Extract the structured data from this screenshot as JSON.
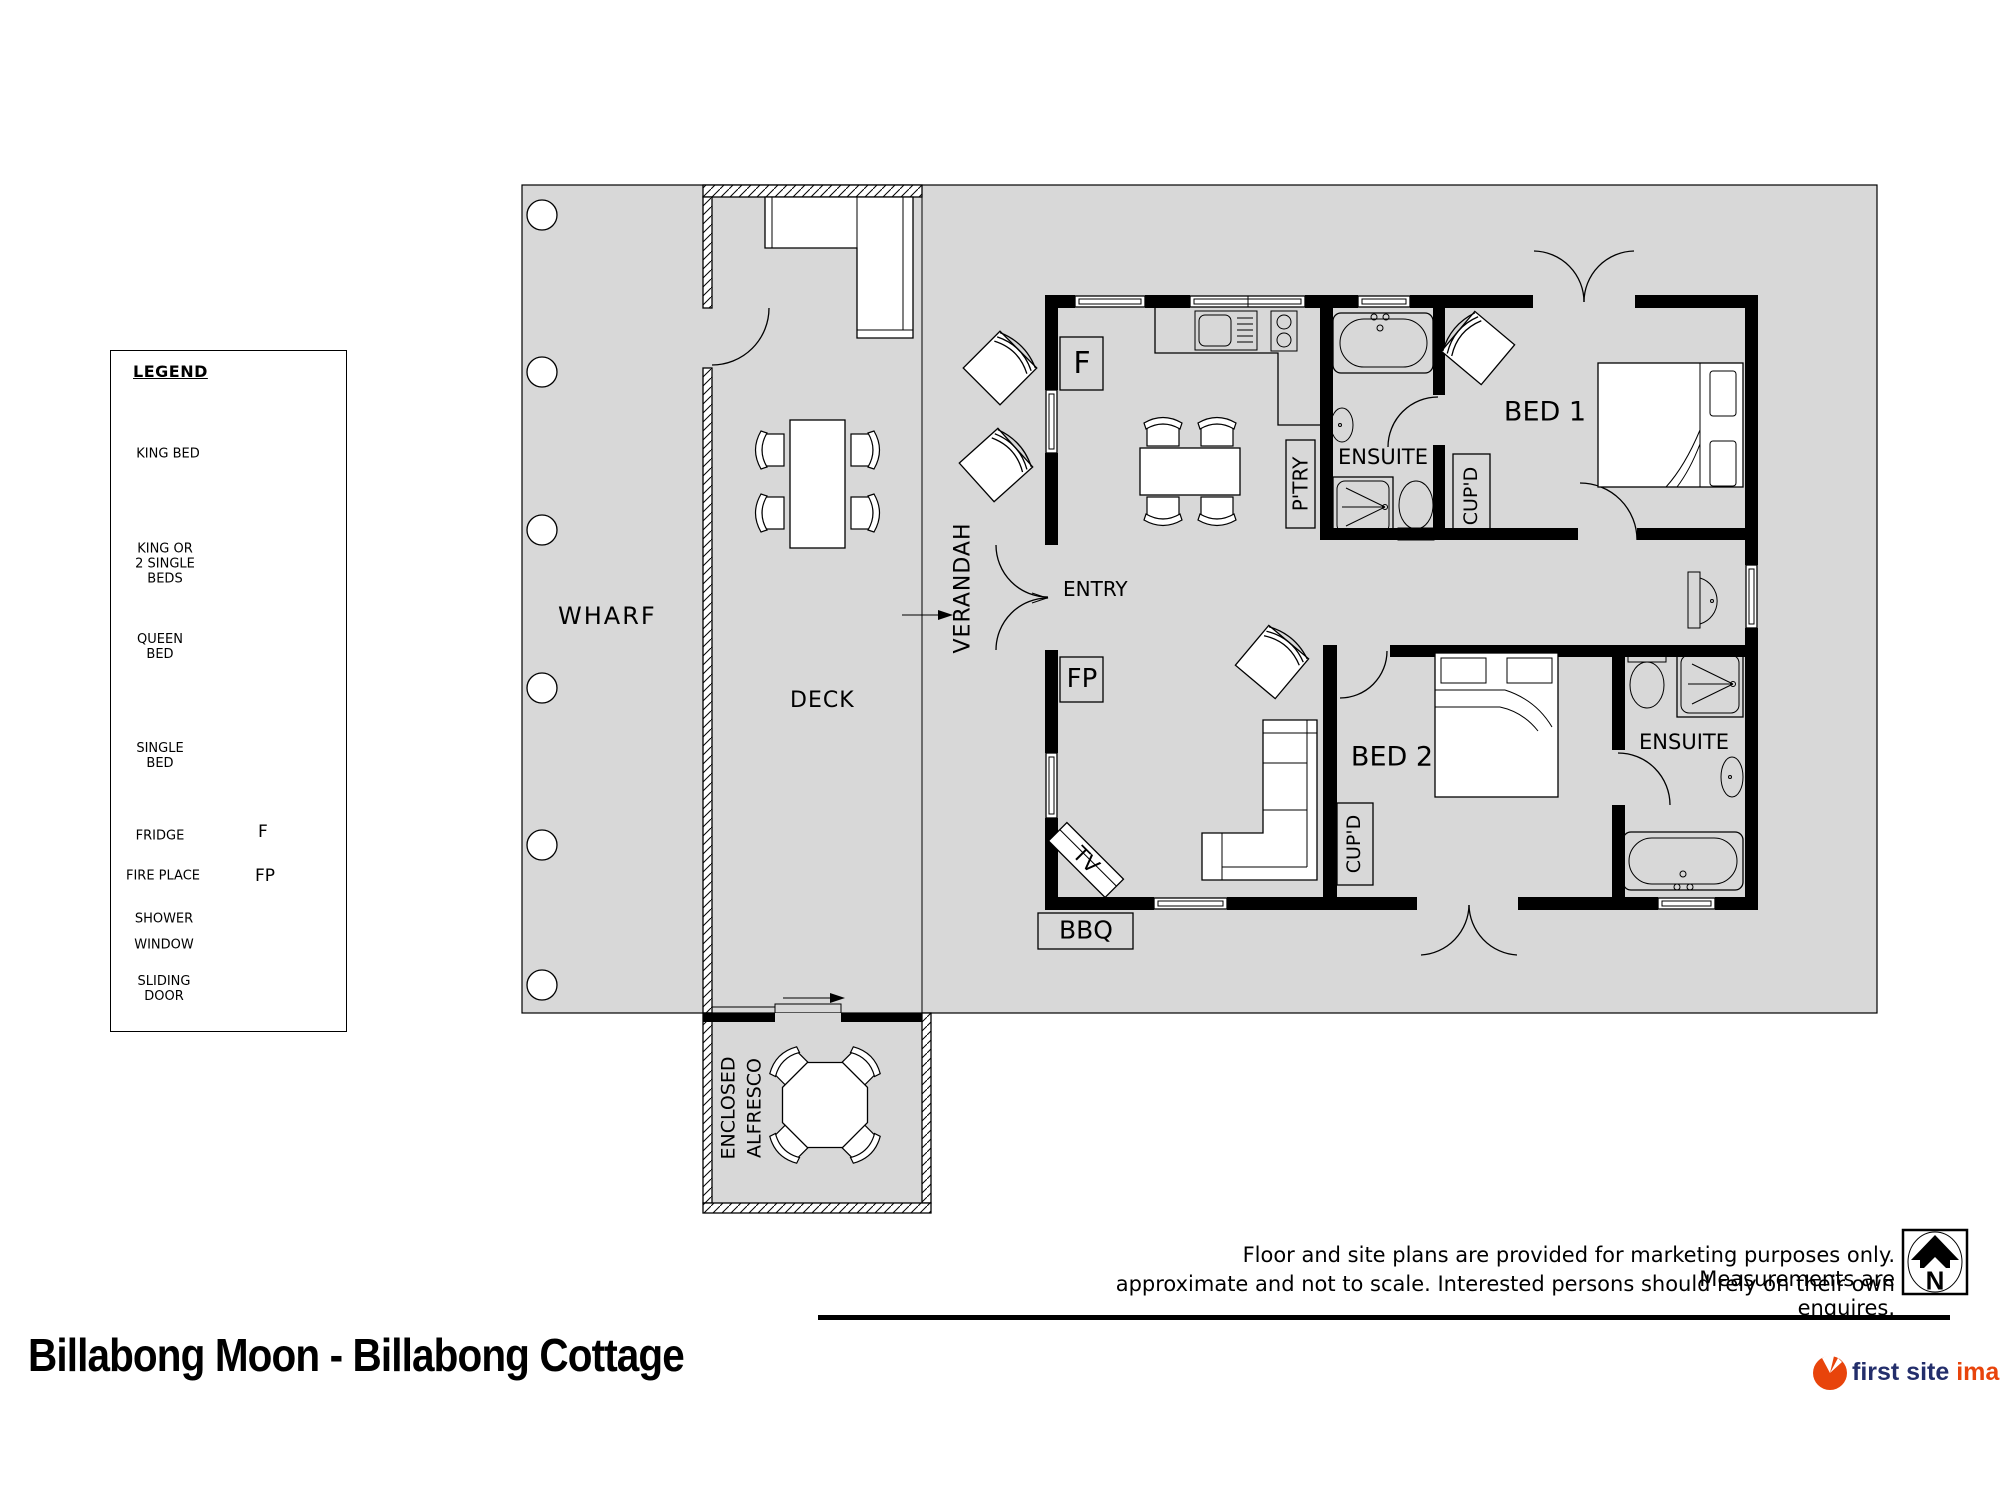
{
  "colors": {
    "plan-gray": "#d8d8d8",
    "ink": "#000000",
    "logo-navy": "#232e6b",
    "logo-orange": "#e8440b"
  },
  "legend": {
    "heading": "LEGEND",
    "items": [
      {
        "label": "KING BED",
        "icon": "king-bed-icon"
      },
      {
        "label": "KING OR\n2 SINGLE\nBEDS",
        "icon": "king-or-two-single-beds-icon"
      },
      {
        "label": "QUEEN\nBED",
        "icon": "queen-bed-icon"
      },
      {
        "label": "SINGLE\nBED",
        "icon": "single-bed-icon"
      },
      {
        "label": "FRIDGE",
        "icon": "fridge-icon"
      },
      {
        "label": "FIRE PLACE",
        "icon": "fireplace-icon"
      },
      {
        "label": "SHOWER",
        "icon": "shower-icon"
      },
      {
        "label": "WINDOW",
        "icon": "window-icon"
      },
      {
        "label": "SLIDING\nDOOR",
        "icon": "sliding-door-icon"
      }
    ]
  },
  "plan": {
    "areas": {
      "wharf": "WHARF",
      "deck": "DECK",
      "verandah": "VERANDAH",
      "entry": "ENTRY",
      "alfresco": "ENCLOSED\nALFRESCO"
    },
    "rooms": {
      "bed1": "BED 1",
      "bed2": "BED 2",
      "ensuite1": "ENSUITE",
      "ensuite2": "ENSUITE"
    },
    "features": {
      "fridge": "F",
      "fireplace": "FP",
      "pantry": "P'TRY",
      "cupboard1": "CUP'D",
      "cupboard2": "CUP'D",
      "tv": "TV",
      "bbq": "BBQ"
    }
  },
  "north": {
    "label": "N"
  },
  "disclaimer": {
    "line1": "Floor and site plans are provided for marketing purposes only. Measurements are",
    "line2": "approximate and not to scale. Interested persons should rely on their own enquires."
  },
  "footer": {
    "title": "Billabong Moon - Billabong Cottage",
    "logo_text_primary": "first site",
    "logo_text_secondary": "imaging"
  }
}
